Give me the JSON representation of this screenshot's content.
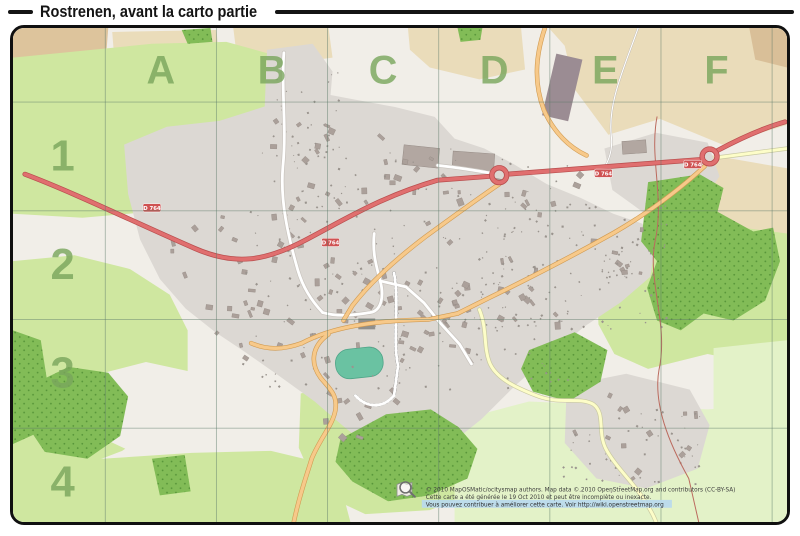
{
  "title": "Rostrenen, avant la carto partie",
  "grid": {
    "columns": [
      "A",
      "B",
      "C",
      "D",
      "E",
      "F"
    ],
    "rows": [
      "1",
      "2",
      "3",
      "4"
    ]
  },
  "road_shield_label": "D 764",
  "footer": {
    "line1": "© 2010 MapOSMatic/ocitysmap authors. Map data © 2010 OpenStreetMap.org and contributors (CC-BY-SA)",
    "line2": "Cette carte a été générée le 19 Oct 2010 et peut être incomplète ou inexacte.",
    "line3": "Vous pouvez contribuer à améliorer cette carte. Voir http://wiki.openstreetmap.org"
  },
  "colors": {
    "grid_label": "#79a65c",
    "trunk_road": "#e06f6f",
    "secondary_road": "#f7c98a",
    "minor_road": "#fdfdc8",
    "forest": "#82bc57",
    "meadow": "#cfe7a0",
    "pale_meadow": "#e3f2c8",
    "farmland": "#eadcba",
    "urban": "#dcd8d3",
    "building": "#aba09a",
    "stadium": "#6ac2a2",
    "link_highlight": "#b8d9ee"
  }
}
